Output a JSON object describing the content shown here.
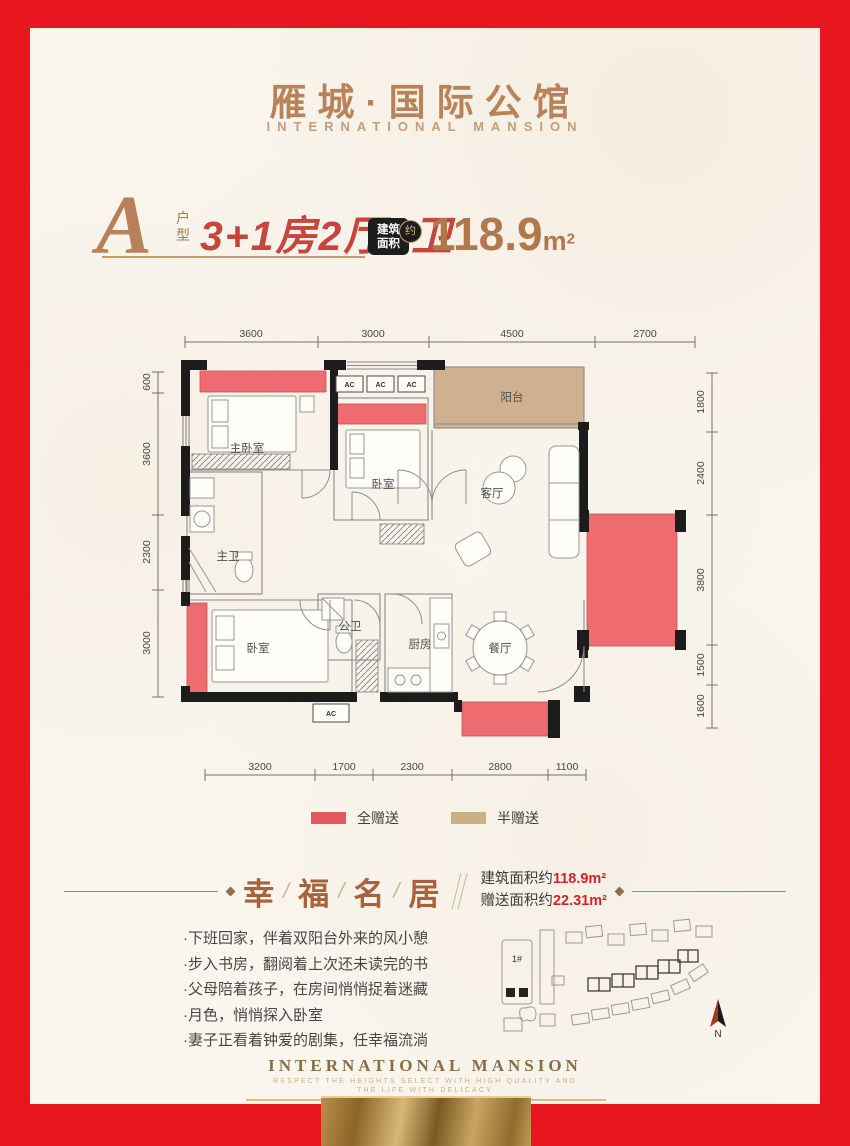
{
  "colors": {
    "frame_red": "#e8161e",
    "copper": "#b9835a",
    "accent_red": "#c7453d",
    "gift_red": "#e4575e",
    "gift_tan": "#c9b183",
    "banner_value_red": "#d2232b"
  },
  "header": {
    "title": "雁城·国际公馆",
    "subtitle": "INTERNATIONAL MANSION"
  },
  "unit": {
    "letter": "A",
    "suffix_char1": "户",
    "suffix_char2": "型",
    "rooms_text": "3+1房2厅2卫",
    "badge": {
      "line1": "建筑",
      "line2": "面积",
      "circle": "约"
    },
    "area_value": "118.9",
    "area_unit": "m",
    "area_sup": "2"
  },
  "floorplan": {
    "dims_top": [
      "3600",
      "3000",
      "4500",
      "2700"
    ],
    "dims_left": [
      "600",
      "3600",
      "2300",
      "3000"
    ],
    "dims_right": [
      "1800",
      "2400",
      "3800",
      "1500",
      "1600"
    ],
    "dims_bottom": [
      "3200",
      "1700",
      "2300",
      "2800",
      "1100"
    ],
    "rooms": {
      "master_bedroom": "主卧室",
      "bedroom2": "卧室",
      "balcony": "阳台",
      "living": "客厅",
      "master_bath": "主卫",
      "bedroom3": "卧室",
      "public_bath": "公卫",
      "kitchen": "厨房",
      "dining": "餐厅"
    },
    "ac_label": "AC"
  },
  "legend": {
    "full_gift": {
      "label": "全赠送",
      "color": "#e4575e"
    },
    "half_gift": {
      "label": "半赠送",
      "color": "#c9b183"
    }
  },
  "banner": {
    "chars": [
      "幸",
      "福",
      "名",
      "居"
    ],
    "separator": "/",
    "line1_label": "建筑面积约",
    "line1_value": "118.9m²",
    "line2_label": "赠送面积约",
    "line2_value": "22.31m²"
  },
  "bullets": [
    "·下班回家，伴着双阳台外来的风小憩",
    "·步入书房，翻阅着上次还未读完的书",
    "·父母陪着孩子，在房间悄悄捉着迷藏",
    "·月色，悄悄探入卧室",
    "·妻子正看着钟爱的剧集，任幸福流淌"
  ],
  "siteplan": {
    "building_label": "1#",
    "north_label": "N"
  },
  "footer": {
    "title": "INTERNATIONAL MANSION",
    "tagline1": "RESPECT THE HEIGHTS SELECT WITH HIGH QUALITY AND",
    "tagline2": "THE LIFE WITH DELICACY"
  }
}
